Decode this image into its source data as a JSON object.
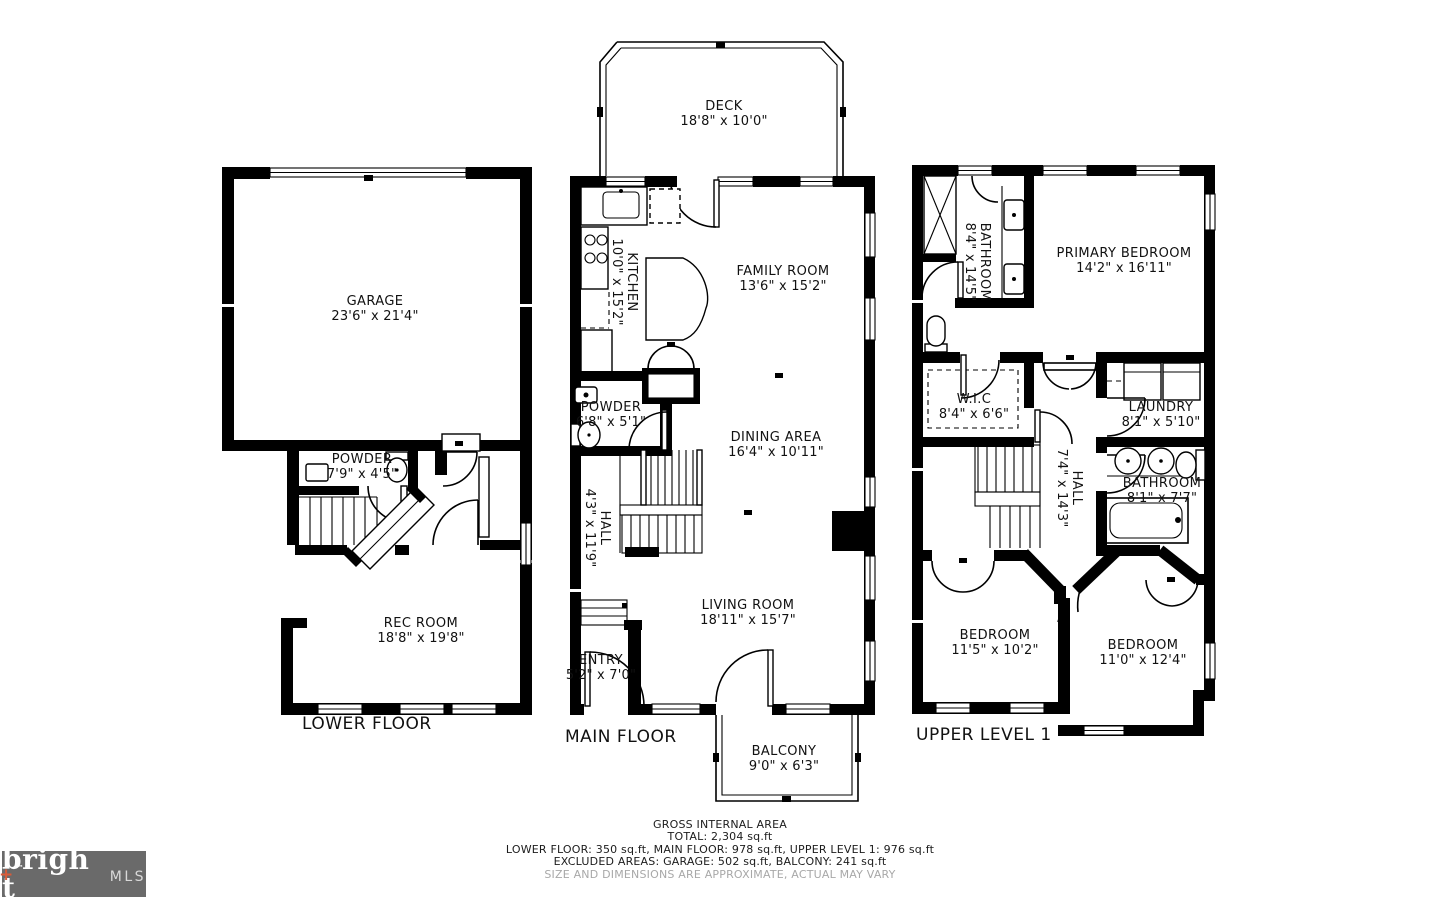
{
  "plan": {
    "floors": [
      {
        "id": "lower",
        "label": "LOWER FLOOR",
        "rooms": [
          {
            "name": "GARAGE",
            "dims": "23'6\" x 21'4\""
          },
          {
            "name": "POWDER",
            "dims": "7'9\" x 4'5\""
          },
          {
            "name": "REC ROOM",
            "dims": "18'8\" x 19'8\""
          }
        ]
      },
      {
        "id": "main",
        "label": "MAIN FLOOR",
        "rooms": [
          {
            "name": "DECK",
            "dims": "18'8\" x 10'0\""
          },
          {
            "name": "KITCHEN",
            "dims": "10'0\" x 15'2\""
          },
          {
            "name": "FAMILY ROOM",
            "dims": "13'6\" x 15'2\""
          },
          {
            "name": "POWDER",
            "dims": "6'8\" x 5'1\""
          },
          {
            "name": "DINING AREA",
            "dims": "16'4\" x 10'11\""
          },
          {
            "name": "HALL",
            "dims": "4'3\" x 11'9\""
          },
          {
            "name": "LIVING ROOM",
            "dims": "18'11\" x 15'7\""
          },
          {
            "name": "ENTRY",
            "dims": "5'2\" x 7'0\""
          },
          {
            "name": "BALCONY",
            "dims": "9'0\" x 6'3\""
          }
        ]
      },
      {
        "id": "upper",
        "label": "UPPER LEVEL 1",
        "rooms": [
          {
            "name": "BATHROOM",
            "dims": "8'4\" x 14'5\""
          },
          {
            "name": "PRIMARY BEDROOM",
            "dims": "14'2\" x 16'11\""
          },
          {
            "name": "W.I.C",
            "dims": "8'4\" x 6'6\""
          },
          {
            "name": "LAUNDRY",
            "dims": "8'1\" x 5'10\""
          },
          {
            "name": "HALL",
            "dims": "7'4\" x 14'3\""
          },
          {
            "name": "BATHROOM",
            "dims": "8'1\" x 7'7\""
          },
          {
            "name": "BEDROOM",
            "dims": "11'5\" x 10'2\""
          },
          {
            "name": "BEDROOM",
            "dims": "11'0\" x 12'4\""
          }
        ]
      }
    ]
  },
  "footer": {
    "line1": "GROSS INTERNAL AREA",
    "line2": "TOTAL: 2,304 sq.ft",
    "line3": "LOWER FLOOR: 350 sq.ft, MAIN FLOOR: 978 sq.ft, UPPER LEVEL 1: 976 sq.ft",
    "line4": "EXCLUDED AREAS: GARAGE: 502 sq.ft, BALCONY: 241 sq.ft",
    "line5": "SIZE AND DIMENSIONS ARE APPROXIMATE, ACTUAL MAY VARY"
  },
  "logo": {
    "brand_part1": "brigh",
    "brand_part2": "t",
    "plus": "+",
    "tm": "™",
    "suffix": "MLS"
  },
  "colors": {
    "wall": "#000000",
    "background": "#ffffff",
    "muted_text": "#a8a8a8",
    "logo_bg": "#6a6a6a",
    "logo_accent": "#d95b38"
  }
}
